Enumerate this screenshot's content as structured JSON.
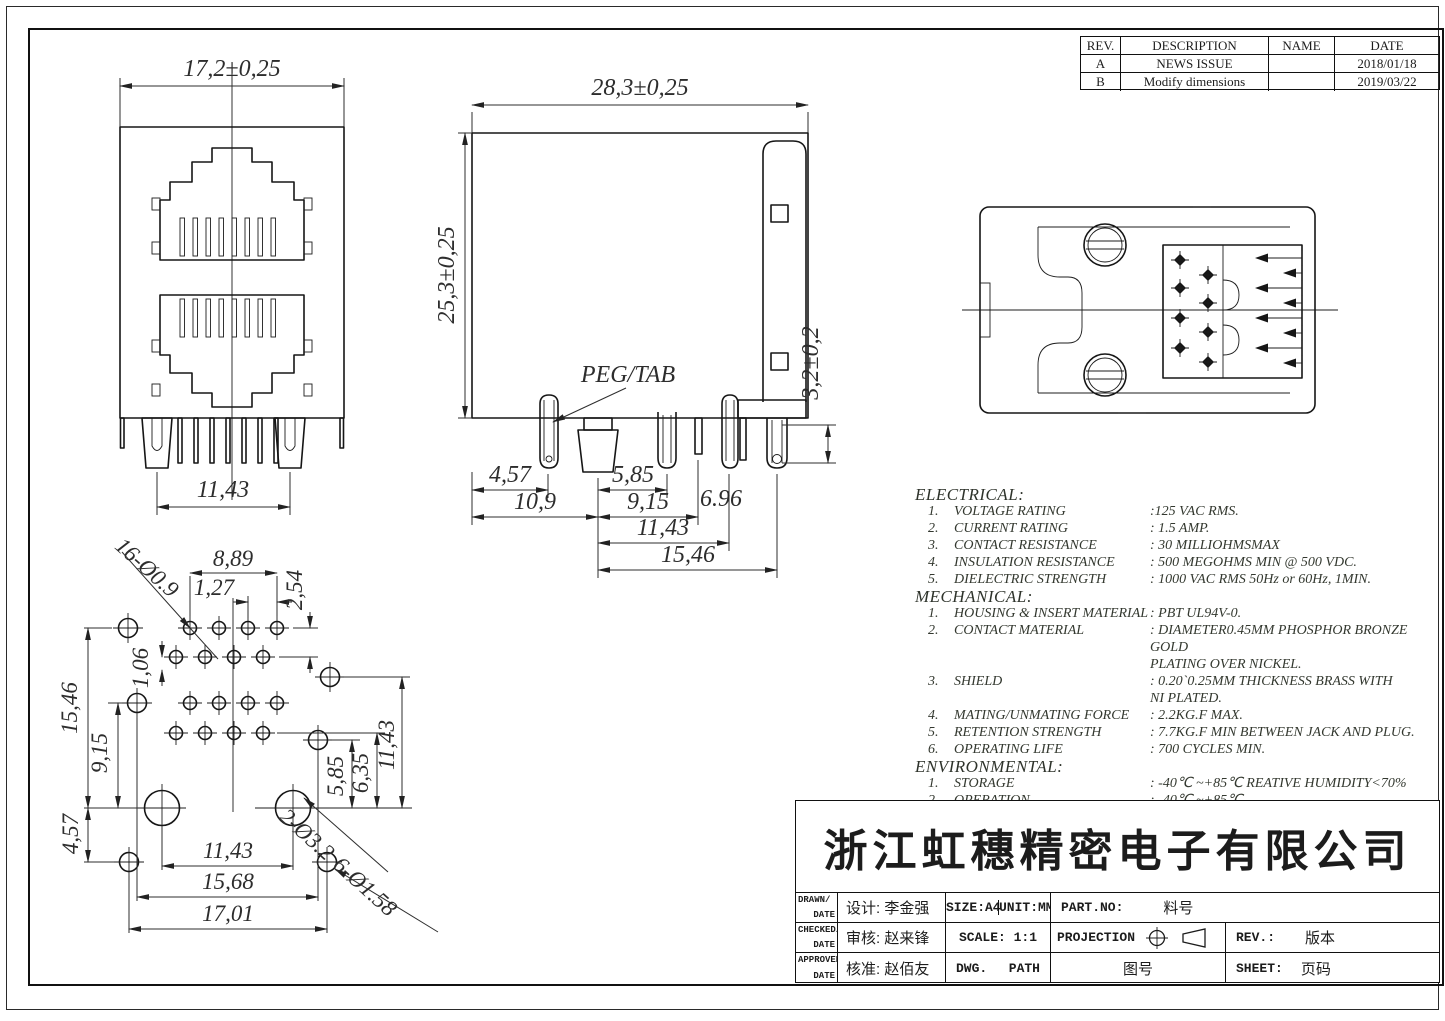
{
  "revision_table": {
    "headers": [
      "REV.",
      "DESCRIPTION",
      "NAME",
      "DATE"
    ],
    "rows": [
      {
        "rev": "A",
        "description": "NEWS ISSUE",
        "name": "",
        "date": "2018/01/18"
      },
      {
        "rev": "B",
        "description": "Modify dimensions",
        "name": "",
        "date": "2019/03/22"
      }
    ]
  },
  "front_view": {
    "width_dim": "17,2±0,25",
    "pins_dim": "11,43"
  },
  "side_view": {
    "width_dim": "28,3±0,25",
    "height_dim": "25,3±0,25",
    "peg_label": "PEG/TAB",
    "dim_a": "4,57",
    "dim_b": "5,85",
    "dim_c": "10,9",
    "dim_d": "9,15",
    "dim_e": "11,43",
    "dim_f": "15,46",
    "dim_g": "6.96",
    "dim_h": "3,2±0,2"
  },
  "footprint": {
    "callout_small_holes": "16-Ø0.9",
    "dim_889": "8,89",
    "dim_127": "1,27",
    "dim_254": "2,54",
    "dim_106": "1,06",
    "dim_1546": "15,46",
    "dim_915": "9,15",
    "dim_457": "4,57",
    "dim_585": "5,85",
    "dim_635": "6,35",
    "dim_1143_right": "11,43",
    "dim_1143_bottom": "11,43",
    "dim_1568": "15,68",
    "dim_1701": "17,01",
    "callout_big_holes": "2-Ø3.2",
    "callout_mid_holes": "6-Ø1.58"
  },
  "specs": {
    "electrical": {
      "title": "ELECTRICAL:",
      "items": [
        {
          "num": "1.",
          "name": "VOLTAGE RATING",
          "value": ":125 VAC RMS."
        },
        {
          "num": "2.",
          "name": "CURRENT RATING",
          "value": ": 1.5 AMP."
        },
        {
          "num": "3.",
          "name": "CONTACT RESISTANCE",
          "value": ": 30 MILLIOHMSMAX"
        },
        {
          "num": "4.",
          "name": "INSULATION RESISTANCE",
          "value": ": 500 MEGOHMS MIN @ 500 VDC."
        },
        {
          "num": "5.",
          "name": "DIELECTRIC STRENGTH",
          "value": ": 1000 VAC RMS 50Hz  or 60Hz, 1MIN."
        }
      ]
    },
    "mechanical": {
      "title": "MECHANICAL:",
      "items": [
        {
          "num": "1.",
          "name": "HOUSING & INSERT MATERIAL",
          "value": ": PBT UL94V-0."
        },
        {
          "num": "2.",
          "name": "CONTACT MATERIAL",
          "value": ": DIAMETER0.45MM PHOSPHOR BRONZE GOLD\nPLATING OVER NICKEL."
        },
        {
          "num": "3.",
          "name": "SHIELD",
          "value": ": 0.20`0.25MM THICKNESS BRASS WITH\nNI PLATED."
        },
        {
          "num": "4.",
          "name": "MATING/UNMATING FORCE",
          "value": ": 2.2KG.F MAX."
        },
        {
          "num": "5.",
          "name": "RETENTION STRENGTH",
          "value": ": 7.7KG.F MIN BETWEEN JACK AND PLUG."
        },
        {
          "num": "6.",
          "name": "OPERATING LIFE",
          "value": ": 700 CYCLES MIN."
        }
      ]
    },
    "environmental": {
      "title": "ENVIRONMENTAL:",
      "items": [
        {
          "num": "1.",
          "name": "STORAGE",
          "value": ": -40℃ ~+85℃ REATIVE HUMIDITY<70%"
        },
        {
          "num": "2.",
          "name": "OPERATION",
          "value": ": -40℃ ~+85℃"
        }
      ]
    }
  },
  "title_block": {
    "company": "浙江虹穗精密电子有限公司",
    "row1": {
      "left_top": "DRAWN/",
      "left_bottom": "DATE",
      "designer": "设计: 李金强",
      "size": "SIZE:A4",
      "unit": "UNIT:MM.",
      "part_label": "PART.NO:",
      "part_value": "料号"
    },
    "row2": {
      "left_top": "CHECKED/",
      "left_bottom": "DATE",
      "checker": "审核: 赵来锋",
      "scale": "SCALE: 1:1",
      "projection": "PROJECTION",
      "rev_label": "REV.:",
      "rev_value": "版本"
    },
    "row3": {
      "left_top": "APPROVED/",
      "left_bottom": "DATE",
      "approver": "核准: 赵佰友",
      "dwg": "DWG.",
      "path": "PATH",
      "dwg_no": "图号",
      "sheet_label": "SHEET:",
      "sheet_value": "页码"
    }
  }
}
